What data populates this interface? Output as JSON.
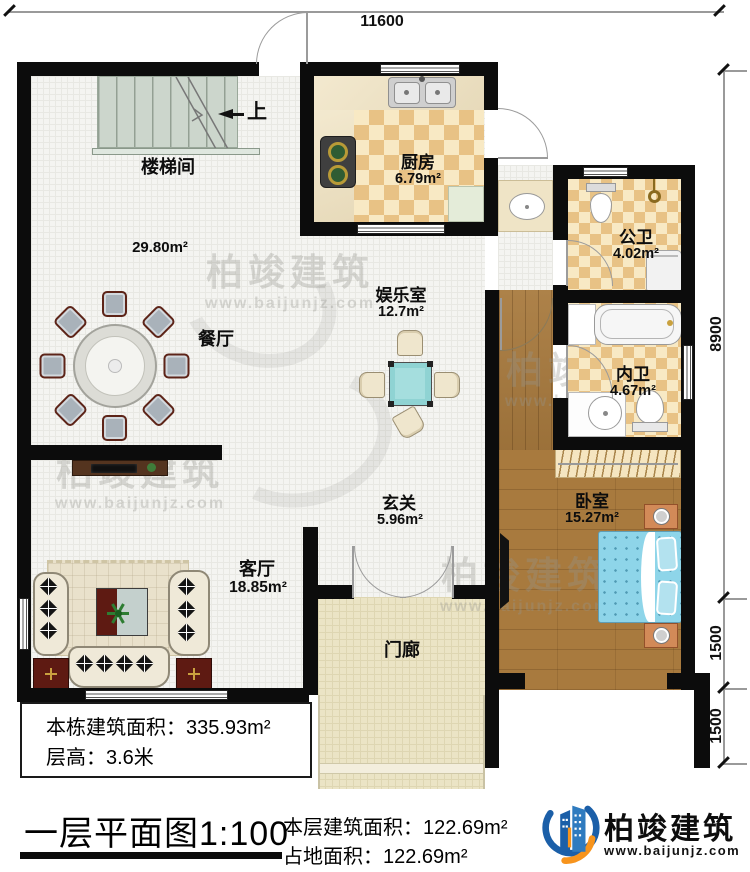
{
  "title": {
    "text": "一层平面图1:100"
  },
  "dimensions": {
    "top": "11600",
    "right_upper": "8900",
    "right_middle": "1500",
    "right_lower": "1500"
  },
  "stairs": {
    "room": "楼梯间",
    "direction": "上",
    "hall_area": "29.80m²"
  },
  "rooms": {
    "kitchen": {
      "name": "厨房",
      "area": "6.79m²"
    },
    "public_bath": {
      "name": "公卫",
      "area": "4.02m²"
    },
    "ensuite_bath": {
      "name": "内卫",
      "area": "4.67m²"
    },
    "entertainment": {
      "name": "娱乐室",
      "area": "12.7m²"
    },
    "dining": {
      "name": "餐厅"
    },
    "foyer": {
      "name": "玄关",
      "area": "5.96m²"
    },
    "living": {
      "name": "客厅",
      "area": "18.85m²"
    },
    "bedroom": {
      "name": "卧室",
      "area": "15.27m²"
    },
    "porch": {
      "name": "门廊"
    }
  },
  "info_box": {
    "building_area": "本栋建筑面积：335.93m²",
    "floor_height": "层高：3.6米"
  },
  "footer": {
    "floor_area": "本层建筑面积：122.69m²",
    "land_area": "占地面积：122.69m²"
  },
  "brand": {
    "name": "柏竣建筑",
    "website": "www.baijunjz.com"
  },
  "watermark": {
    "name": "柏竣建筑",
    "website": "www.baijunjz.com"
  },
  "colors": {
    "wall": "#0c0c0c",
    "checker_dark": "#e8c285",
    "checker_light": "#f8e9c4",
    "wood": "#a87a3e",
    "porch": "#ebe4c5",
    "bed": "#8ed5e9",
    "game_table": "#8fd3d3",
    "brand_blue": "#1b5fa8",
    "brand_orange": "#f7941d"
  }
}
